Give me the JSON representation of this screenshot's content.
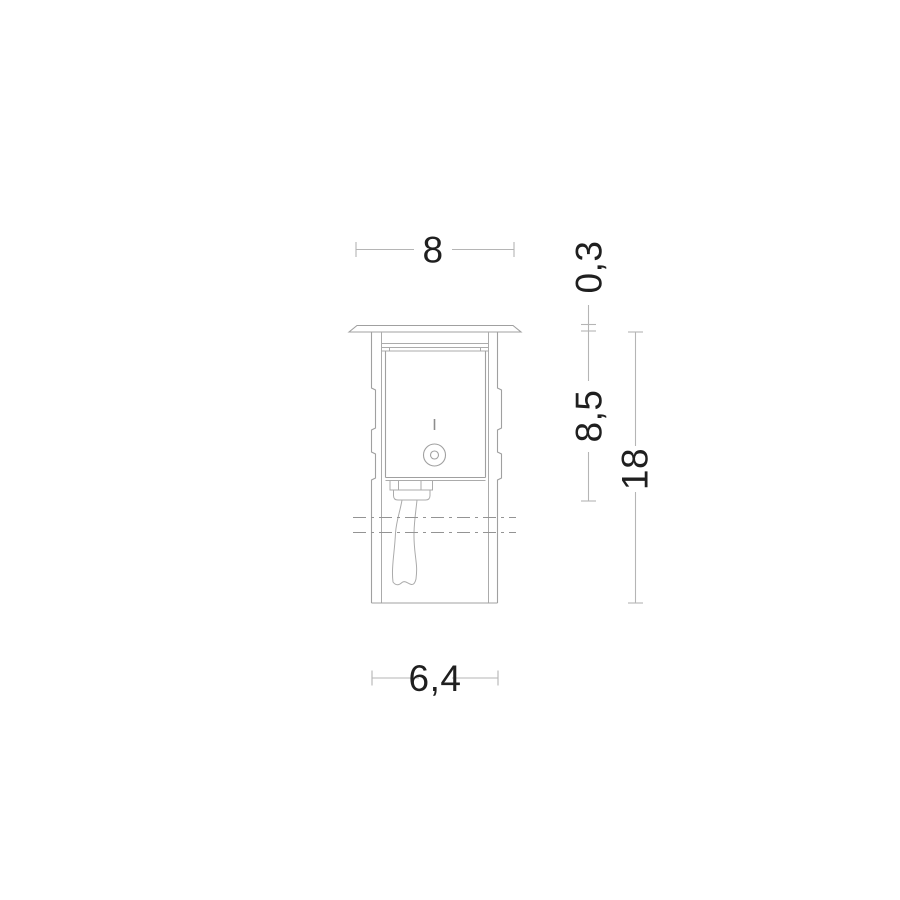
{
  "drawing": {
    "kind": "technical-dimension-drawing",
    "subject": "recessed in-ground luminaire, side elevation with installation depth",
    "units_note": "",
    "dimensions": {
      "top_width": "8",
      "flange_thickness": "0,3",
      "recess_depth": "8,5",
      "total_depth": "18",
      "body_width": "6,4"
    },
    "colors": {
      "background": "#ffffff",
      "object_line": "#a0a0a0",
      "dimension_line": "#b5b5b5",
      "centerline": "#949494",
      "text": "#1f1f1f"
    }
  }
}
